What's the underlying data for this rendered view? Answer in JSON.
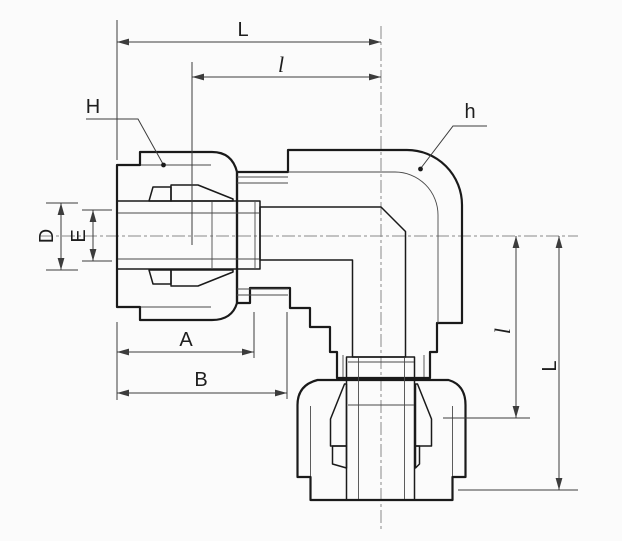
{
  "drawing": {
    "type": "technical-section-drawing",
    "subject": "90-degree elbow compression tube fitting, cross-section with dimension callouts",
    "labels": {
      "length_top": "L",
      "sub_length_top": "l",
      "nut_callout": "H",
      "body_callout": "h",
      "tube_od": "D",
      "tube_id": "E",
      "dim_a": "A",
      "dim_b": "B",
      "sub_length_right": "l",
      "length_right": "L"
    },
    "colors": {
      "background": "#fbfbfb",
      "body_fill": "#d9d9d9",
      "nut_fill": "#c6c6c6",
      "bore_fill": "#ffffff",
      "outline": "#1a1a1a",
      "dim_color": "#3c3c3c"
    }
  }
}
